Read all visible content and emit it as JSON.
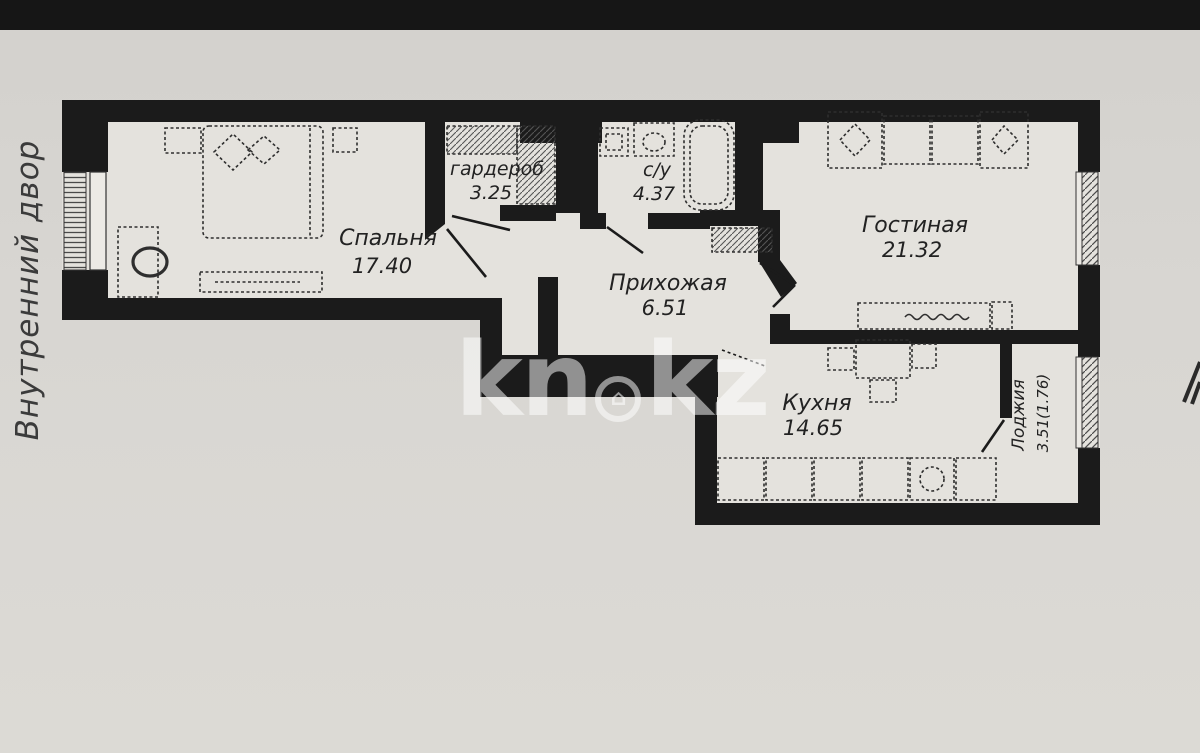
{
  "side_label": "Внутренний двор",
  "watermark": {
    "left": "kn",
    "right": "kz",
    "dot_icon": "house-icon",
    "color": "#ffffff"
  },
  "plan": {
    "wall_color": "#1b1b1b",
    "paper_color": "#e4e2dd",
    "background_color": "#d7d5d1",
    "rooms": [
      {
        "id": "bedroom",
        "name": "Спальня",
        "area": "17.40"
      },
      {
        "id": "wardrobe",
        "name": "гардероб",
        "area": "3.25"
      },
      {
        "id": "bathroom",
        "name": "с/у",
        "area": "4.37"
      },
      {
        "id": "hallway",
        "name": "Прихожая",
        "area": "6.51"
      },
      {
        "id": "living",
        "name": "Гостиная",
        "area": "21.32"
      },
      {
        "id": "kitchen",
        "name": "Кухня",
        "area": "14.65"
      },
      {
        "id": "loggia",
        "name": "Лоджия",
        "area": "3.51(1.76)"
      }
    ]
  }
}
